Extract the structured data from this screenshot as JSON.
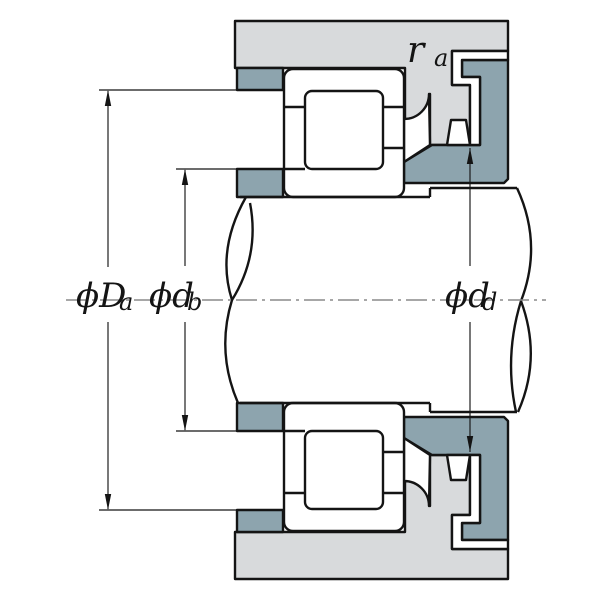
{
  "diagram": {
    "type": "bearing-mounting-cross-section",
    "description": "Cylindrical roller bearing mounted between housing and shaft with abutment rings, shown in half-section about a horizontal centerline",
    "labels": {
      "Da": {
        "main": "ϕD",
        "sub": "a"
      },
      "db": {
        "main": "ϕd",
        "sub": "b"
      },
      "dd": {
        "main": "ϕd",
        "sub": "d"
      },
      "ra": {
        "main": "r",
        "sub": "a"
      }
    },
    "colors": {
      "housing": "#d8dadc",
      "abutment_ring": "#8da4ae",
      "line": "#141414",
      "centerline": "#8a8a8a",
      "background": "#ffffff"
    }
  }
}
